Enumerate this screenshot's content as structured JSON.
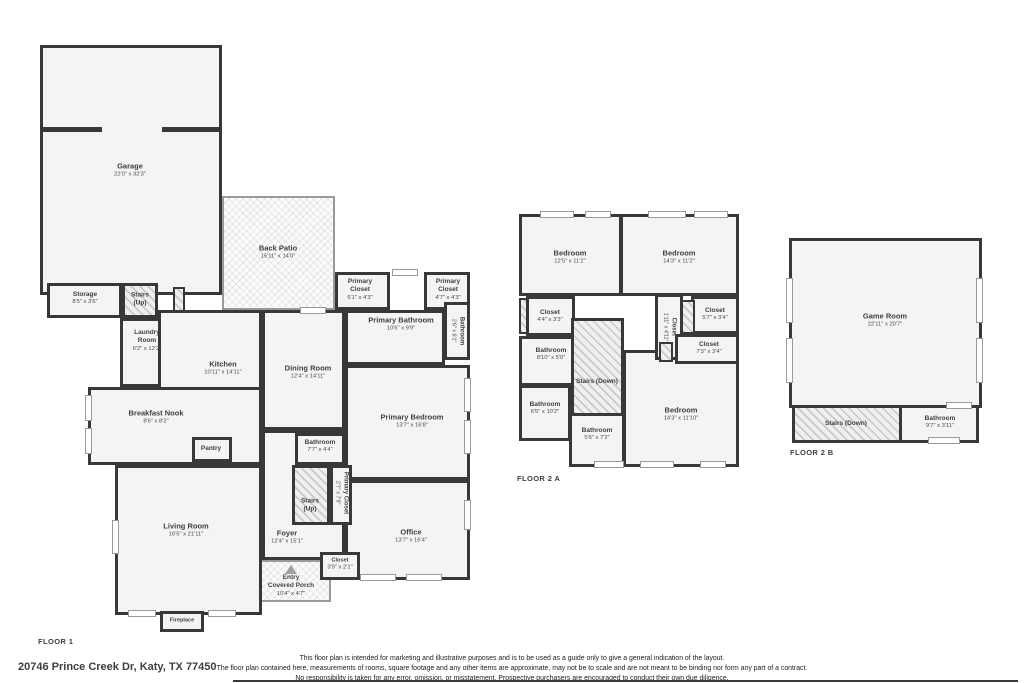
{
  "address": "20746 Prince Creek Dr, Katy, TX 77450",
  "disclaimer": {
    "line1": "This floor plan is intended for marketing and illustrative purposes and is to be used as a guide only to give a general indication of the layout.",
    "line2": "The floor plan contained here, measurements of rooms, square footage and any other items are approximate, may not be to scale and are not meant to be binding nor form any part of a contract.",
    "line3": "No responsibility is taken for any error, omission, or misstatement. Prospective purchasers are encouraged to conduct their own due diligence."
  },
  "colors": {
    "wall": "#383838",
    "room_fill": "#f4f4f4",
    "text": "#3f3f3f",
    "hatch": "#c9c9c9"
  },
  "floor1": {
    "label": "FLOOR 1",
    "garage": {
      "name": "Garage",
      "dims": "22'0\" x 32'3\""
    },
    "back_patio": {
      "name": "Back Patio",
      "dims": "15'11\" x 14'0\""
    },
    "storage": {
      "name": "Storage",
      "dims": "8'5\" x 3'6\""
    },
    "stairs_up_a": {
      "name": "Stairs (Up)"
    },
    "laundry": {
      "name": "Laundry Room",
      "dims": "6'2\" x 12'2\""
    },
    "kitchen": {
      "name": "Kitchen",
      "dims": "10'11\" x 14'11\""
    },
    "breakfast_nook": {
      "name": "Breakfast Nook",
      "dims": "8'6\" x 8'2\""
    },
    "pantry": {
      "name": "Pantry"
    },
    "dining": {
      "name": "Dining Room",
      "dims": "12'4\" x 14'11\""
    },
    "primary_closet_a": {
      "name": "Primary Closet",
      "dims": "6'1\" x 4'3\""
    },
    "primary_closet_b": {
      "name": "Primary Closet",
      "dims": "4'7\" x 4'3\""
    },
    "primary_bathroom": {
      "name": "Primary Bathroom",
      "dims": "10'6\" x 9'9\""
    },
    "bathroom_small": {
      "name": "Bathroom",
      "dims": "2'6\" x 6'1\""
    },
    "primary_bedroom": {
      "name": "Primary Bedroom",
      "dims": "13'7\" x 16'8\""
    },
    "bathroom_hall": {
      "name": "Bathroom",
      "dims": "7'7\" x 4'4\""
    },
    "primary_closet_c": {
      "name": "Primary Closet",
      "dims": "2'7\" x 7'9\""
    },
    "stairs_up_b": {
      "name": "Stairs (Up)"
    },
    "living": {
      "name": "Living Room",
      "dims": "16'5\" x 21'11\""
    },
    "foyer": {
      "name": "Foyer",
      "dims": "12'4\" x 15'1\""
    },
    "closet_entry": {
      "name": "Closet",
      "dims": "3'9\" x 2'1\""
    },
    "office": {
      "name": "Office",
      "dims": "13'7\" x 16'4\""
    },
    "porch": {
      "name": "Entry",
      "name2": "Covered Porch",
      "dims": "10'4\" x 4'7\""
    },
    "fireplace": {
      "name": "Fireplace"
    }
  },
  "floor2a": {
    "label": "FLOOR 2 A",
    "bedroom_1": {
      "name": "Bedroom",
      "dims": "12'5\" x 11'2\""
    },
    "bedroom_2": {
      "name": "Bedroom",
      "dims": "14'3\" x 11'2\""
    },
    "closet_1": {
      "name": "Closet",
      "dims": "4'4\" x 3'3\""
    },
    "closet_2": {
      "name": "Closet",
      "dims": "1'11\" x 4'11\""
    },
    "closet_3": {
      "name": "Closet",
      "dims": "5'7\" x 3'4\""
    },
    "closet_4": {
      "name": "Closet",
      "dims": "7'3\" x 3'4\""
    },
    "bathroom_1": {
      "name": "Bathroom",
      "dims": "8'10\" x 5'0\""
    },
    "stairs_down": {
      "name": "Stairs (Down)"
    },
    "bathroom_2": {
      "name": "Bathroom",
      "dims": "6'5\" x 10'2\""
    },
    "bathroom_3": {
      "name": "Bathroom",
      "dims": "5'6\" x 7'2\""
    },
    "bedroom_3": {
      "name": "Bedroom",
      "dims": "14'3\" x 11'10\""
    }
  },
  "floor2b": {
    "label": "FLOOR 2 B",
    "game_room": {
      "name": "Game Room",
      "dims": "22'11\" x 20'7\""
    },
    "stairs_down": {
      "name": "Stairs (Down)"
    },
    "bathroom": {
      "name": "Bathroom",
      "dims": "9'7\" x 3'11\""
    }
  }
}
